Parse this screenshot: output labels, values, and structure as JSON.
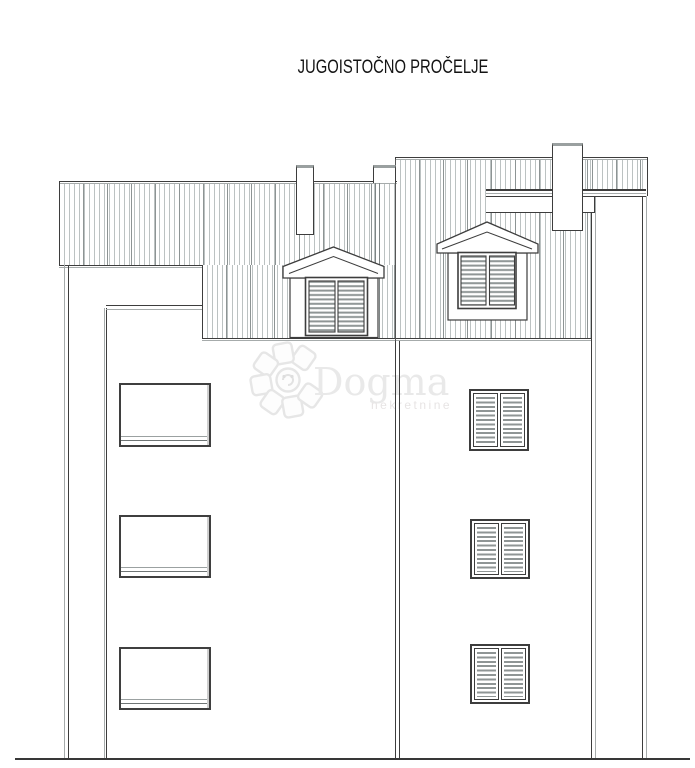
{
  "title": "JUGOISTOČNO PROČELJE",
  "watermark": {
    "brand": "Dogma",
    "tagline": "nekretnine"
  },
  "colors": {
    "background": "#ffffff",
    "line_dark": "#3d3d3d",
    "line_light": "#a6abab",
    "hatch_line": "#bcc2c2",
    "watermark_text": "#e9e9e9"
  }
}
